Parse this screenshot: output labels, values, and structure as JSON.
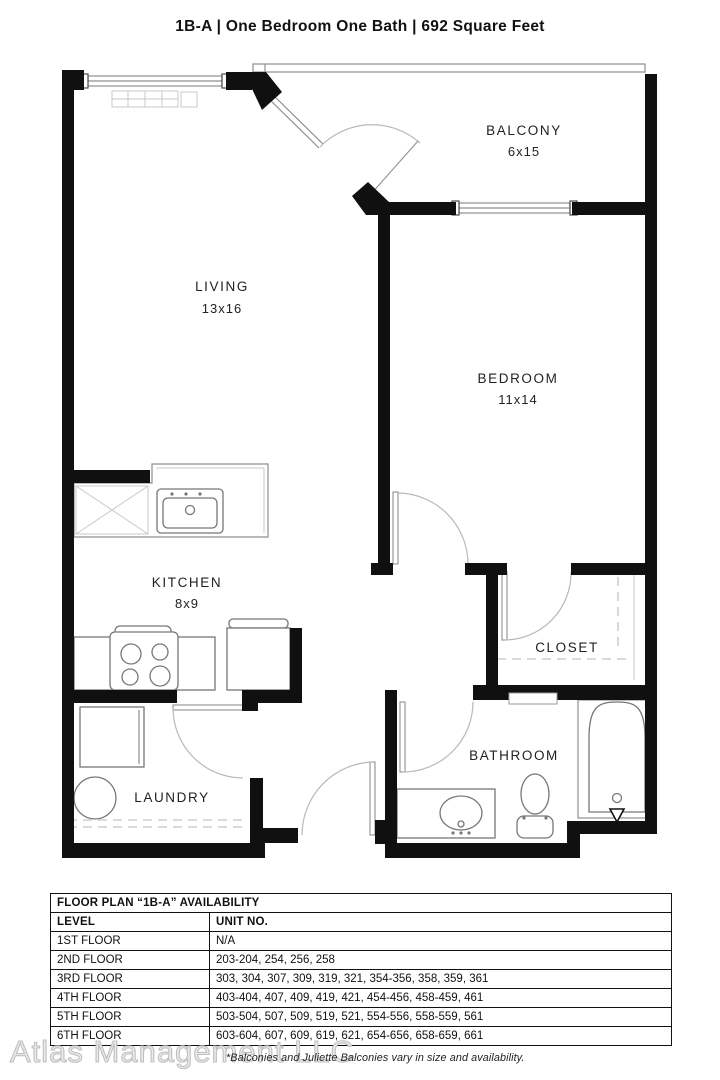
{
  "title": "1B-A | One Bedroom One Bath | 692 Square Feet",
  "floor_plan": {
    "rooms": [
      {
        "id": "living",
        "label": "LIVING",
        "dims": "13x16"
      },
      {
        "id": "balcony",
        "label": "BALCONY",
        "dims": "6x15"
      },
      {
        "id": "bedroom",
        "label": "BEDROOM",
        "dims": "11x14"
      },
      {
        "id": "kitchen",
        "label": "KITCHEN",
        "dims": "8x9"
      },
      {
        "id": "closet",
        "label": "CLOSET",
        "dims": ""
      },
      {
        "id": "laundry",
        "label": "LAUNDRY",
        "dims": ""
      },
      {
        "id": "bathroom",
        "label": "BATHROOM",
        "dims": ""
      }
    ],
    "fixtures": [
      "kitchen-sink",
      "dishwasher",
      "stove",
      "refrigerator",
      "washer",
      "dryer",
      "vanity-sink",
      "toilet",
      "bathtub",
      "hvac-unit"
    ]
  },
  "availability_table": {
    "title": "FLOOR PLAN “1B-A” AVAILABILITY",
    "columns": [
      "LEVEL",
      "UNIT NO."
    ],
    "rows": [
      [
        "1ST FLOOR",
        "N/A"
      ],
      [
        "2ND FLOOR",
        "203-204, 254, 256, 258"
      ],
      [
        "3RD FLOOR",
        "303, 304, 307, 309, 319, 321, 354-356, 358, 359, 361"
      ],
      [
        "4TH FLOOR",
        "403-404, 407, 409, 419, 421, 454-456, 458-459, 461"
      ],
      [
        "5TH FLOOR",
        "503-504, 507, 509, 519, 521, 554-556, 558-559, 561"
      ],
      [
        "6TH FLOOR",
        "603-604, 607, 609, 619, 621, 654-656, 658-659, 661"
      ]
    ]
  },
  "footer": {
    "watermark": "Atlas Management LLC",
    "note": "*Balconies and Juliette Balconies vary in size and availability."
  },
  "colors": {
    "wall": "#101010",
    "fixture_line": "#8f8f8f",
    "text": "#1b1b1b",
    "watermark": "#bfbfbf"
  }
}
